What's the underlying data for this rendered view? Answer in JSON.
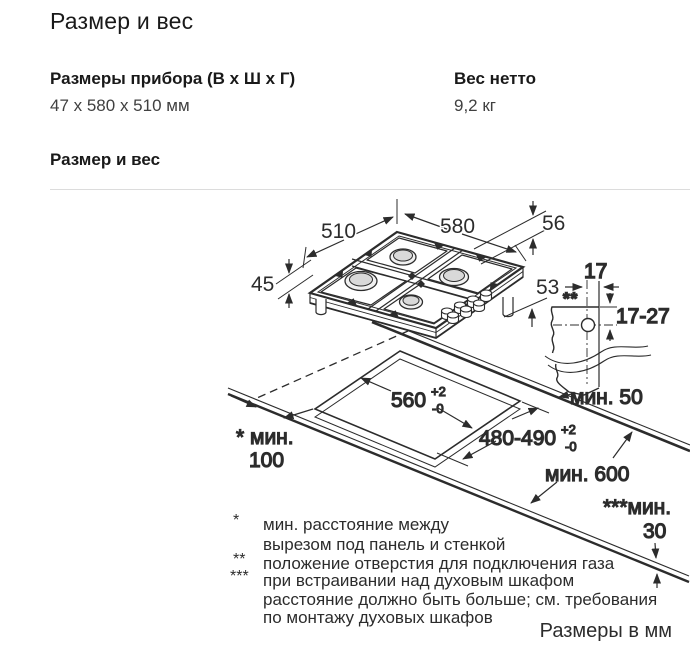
{
  "page": {
    "title": "Размер и вес"
  },
  "specs": {
    "dimensions_label": "Размеры прибора (В х Ш х Г)",
    "dimensions_value": "47 x 580 x 510 мм",
    "weight_label": "Вес нетто",
    "weight_value": "9,2 кг"
  },
  "section": {
    "title": "Размер и вес"
  },
  "diagram": {
    "dims": {
      "depth": "510",
      "width": "580",
      "height_total": "56",
      "height_body": "45",
      "depth_below": "53",
      "gas_edge_offset": "17",
      "gas_vertical_range": "17-27",
      "gas_hole_marker": "**",
      "cutout_width": "560",
      "tol_plus": "+2",
      "tol_minus": "-0",
      "cutout_depth": "480-490",
      "min_rear": "мин. 50",
      "min_side_label": "* мин.",
      "min_side_value": "100",
      "min_worktop_depth": "мин. 600",
      "min_below_label": "***мин.",
      "min_below_value": "30"
    },
    "footnotes": {
      "f1_marker": "*",
      "f1_line1": "мин. расстояние между",
      "f1_line2": "вырезом под панель и стенкой",
      "f2_marker": "**",
      "f2_line1": "положение отверстия для подключения газа",
      "f3_marker": "***",
      "f3_line1": "при встраивании над духовым шкафом",
      "f3_line2": "расстояние должно быть больше; см. требования",
      "f3_line3": "по монтажу духовых шкафов"
    },
    "units_note": "Размеры в мм"
  },
  "colors": {
    "line": "#2c2c2c",
    "heading": "#1a1a1a",
    "body_text": "#404040"
  }
}
